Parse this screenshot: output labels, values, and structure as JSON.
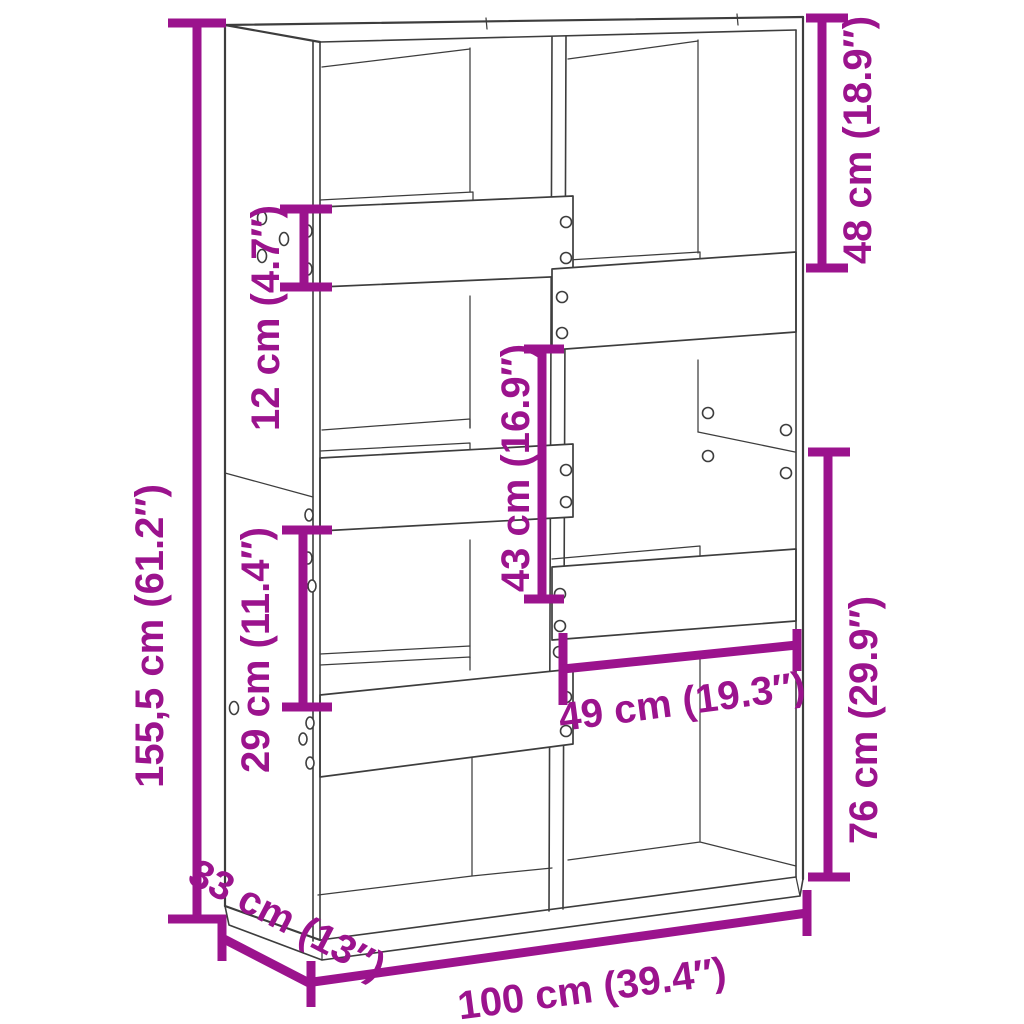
{
  "diagram": {
    "type": "furniture-dimension-diagram",
    "subject": "bookcase-room-divider",
    "background_color": "#ffffff",
    "line_color": "#3d3d3d",
    "accent_color": "#9b138d",
    "units": [
      "cm",
      "inch"
    ],
    "dimensions": [
      {
        "id": "total-height",
        "cm": "155,5",
        "inch": "61.2",
        "label": "155,5 cm (61.2″)"
      },
      {
        "id": "shelf-band-height",
        "cm": "12",
        "inch": "4.7",
        "label": "12 cm (4.7″)"
      },
      {
        "id": "top-right-compartment-height",
        "cm": "48",
        "inch": "18.9",
        "label": "48 cm (18.9″)"
      },
      {
        "id": "middle-compartment-height",
        "cm": "43",
        "inch": "16.9",
        "label": "43 cm (16.9″)"
      },
      {
        "id": "left-compartment-height",
        "cm": "29",
        "inch": "11.4",
        "label": "29 cm (11.4″)"
      },
      {
        "id": "lower-right-section-height",
        "cm": "76",
        "inch": "29.9",
        "label": "76 cm (29.9″)"
      },
      {
        "id": "right-compartment-width",
        "cm": "49",
        "inch": "19.3",
        "label": "49 cm (19.3″)"
      },
      {
        "id": "depth",
        "cm": "33",
        "inch": "13",
        "label": "33 cm (13″)"
      },
      {
        "id": "total-width",
        "cm": "100",
        "inch": "39.4",
        "label": "100 cm (39.4″)"
      }
    ]
  }
}
